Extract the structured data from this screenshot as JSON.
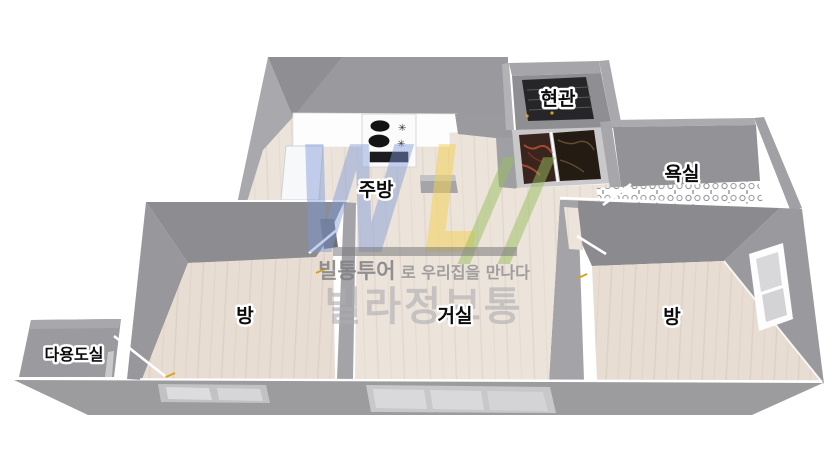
{
  "rooms": [
    {
      "id": "entrance",
      "label": "현관"
    },
    {
      "id": "bathroom",
      "label": "욕실"
    },
    {
      "id": "kitchen",
      "label": "주방"
    },
    {
      "id": "room-left",
      "label": "방"
    },
    {
      "id": "living-room",
      "label": "거실"
    },
    {
      "id": "room-right",
      "label": "방"
    },
    {
      "id": "utility",
      "label": "다용도실"
    }
  ],
  "watermark": {
    "logo_w": "W",
    "logo_l": "L",
    "logo_slashes": "//",
    "tagline_brand": "빌통투어",
    "tagline_rest": "로 우리집을 만나다",
    "brand": "빌라정보통",
    "colors": {
      "blue": "#7d96d7",
      "yellow": "#f3d24b",
      "green": "#9abe5e",
      "gray": "#8a8a8c"
    }
  },
  "palette": {
    "wall_light": "#a9a9ad",
    "wall_mid": "#98989c",
    "wall_dark": "#8b8b8f",
    "floor_wood": "#eae1d8",
    "glass": "#d7d7d9",
    "entrance_mat": "#262628",
    "foyer_marble_left": "#3a241e",
    "foyer_marble_right": "#241b13",
    "accent_tick": "#d8a21f"
  }
}
